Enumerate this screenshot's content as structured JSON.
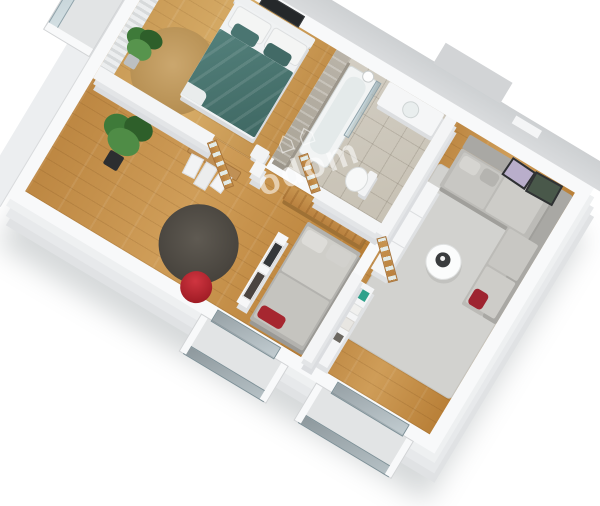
{
  "scene": {
    "type": "3d-isometric-floor-plan-render",
    "background_color": "#ffffff",
    "rotation_deg": 31,
    "watermark": {
      "icon_glyphs": "⌂⌂",
      "text": "odom",
      "color": "rgba(255,255,255,0.55)"
    },
    "palette": {
      "wall_top": "#f8f9fa",
      "wall_face": "#e0e2e4",
      "exterior_band": "#d3d5d7",
      "wood_floor": "#bd8742",
      "wood_floor_light": "#c99a55",
      "tile_floor": "#ccc6ba",
      "stone_accent_wall": "#b1ab9f",
      "rug_living": "#d2d2cf",
      "rug_dark": "#55504a",
      "rug_jute": "#c29c63",
      "bed_duvet_teal": "#497672",
      "sofa_gray": "#bcbbb7",
      "accent_red": "#b2222b",
      "plant_green": "#3e7a39",
      "door_wood": "#c08d4e",
      "glass": "#a9bac1"
    },
    "rooms": [
      {
        "name": "bedroom",
        "floor": "wood",
        "furniture": [
          "double-bed-teal-duvet",
          "white-pillows",
          "headboard",
          "wall-tv",
          "curtains",
          "potted-plant",
          "round-jute-rug",
          "bedside-table"
        ]
      },
      {
        "name": "bathroom",
        "floor": "stone-tile",
        "feature": "stone-accent-wall",
        "furniture": [
          "bathtub",
          "glass-screen",
          "shower-head",
          "toilet",
          "vanity-sink"
        ]
      },
      {
        "name": "hallway",
        "floor": "wood",
        "furniture": [
          "wood-console",
          "open-wood-doors",
          "clothes-rack",
          "art-divider-panel",
          "large-plant",
          "dark-round-rug",
          "red-pouf",
          "daybed-sofa"
        ]
      },
      {
        "name": "living-room",
        "floor": "wood",
        "furniture": [
          "corner-sofa",
          "seat-cushions",
          "round-coffee-table",
          "area-rug",
          "wardrobe-closets",
          "shelf-unit",
          "leaning-art-frames",
          "red-cushion"
        ]
      },
      {
        "name": "balcony-west",
        "feature": "glass-railing"
      },
      {
        "name": "balcony-south-1",
        "feature": "glass-railing"
      },
      {
        "name": "balcony-south-2",
        "feature": "glass-railing"
      }
    ]
  }
}
